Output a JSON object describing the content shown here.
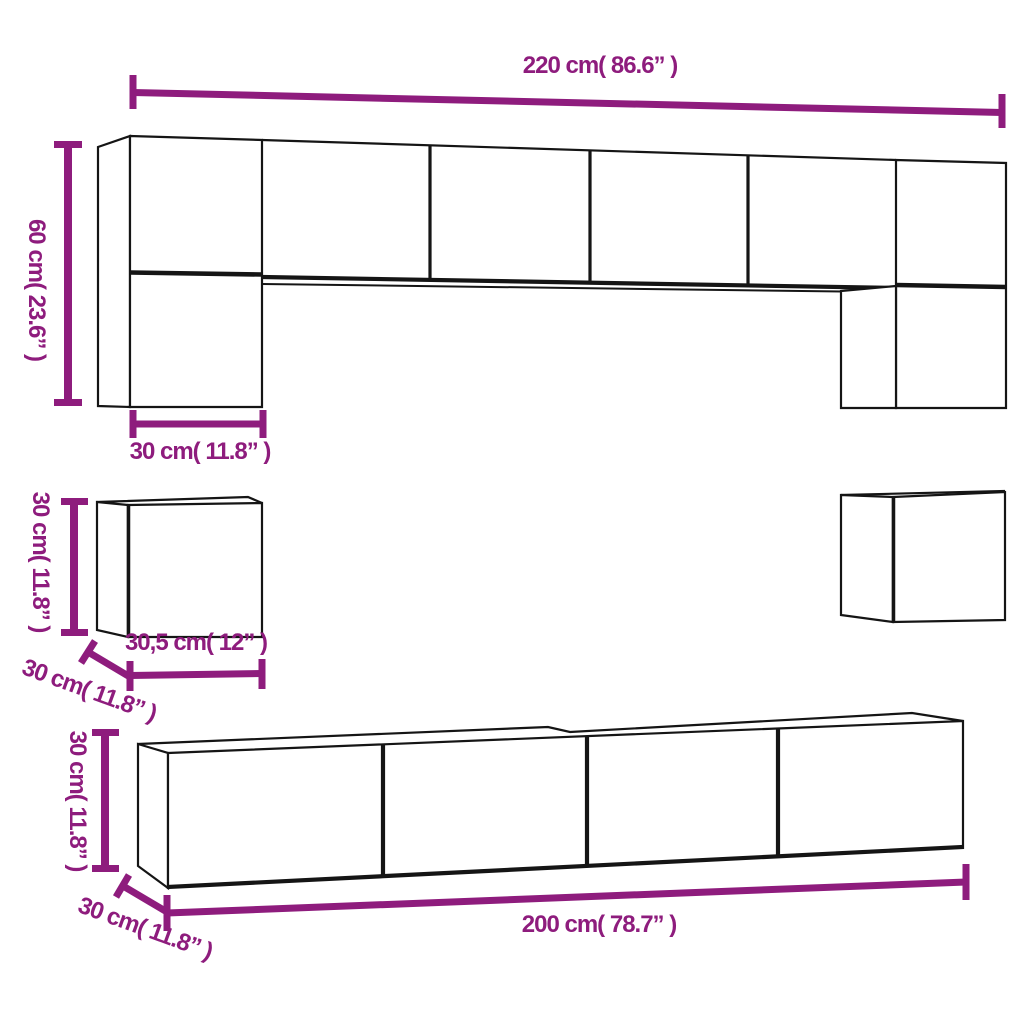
{
  "colors": {
    "dimension": "#8e1c7d",
    "outline": "#151515",
    "background": "#ffffff"
  },
  "dimensions": {
    "wall_unit_width": {
      "label": "220 cm( 86.6” )"
    },
    "wall_unit_height": {
      "label": "60 cm( 23.6” )"
    },
    "wall_unit_depth": {
      "label": "30 cm( 11.8” )"
    },
    "cube_height": {
      "label": "30 cm( 11.8” )"
    },
    "cube_width": {
      "label": "30,5 cm( 12” )"
    },
    "cube_depth": {
      "label": "30 cm( 11.8” )"
    },
    "stand_height": {
      "label": "30 cm( 11.8” )"
    },
    "stand_depth": {
      "label": "30 cm( 11.8” )"
    },
    "stand_width": {
      "label": "200 cm( 78.7” )"
    }
  }
}
